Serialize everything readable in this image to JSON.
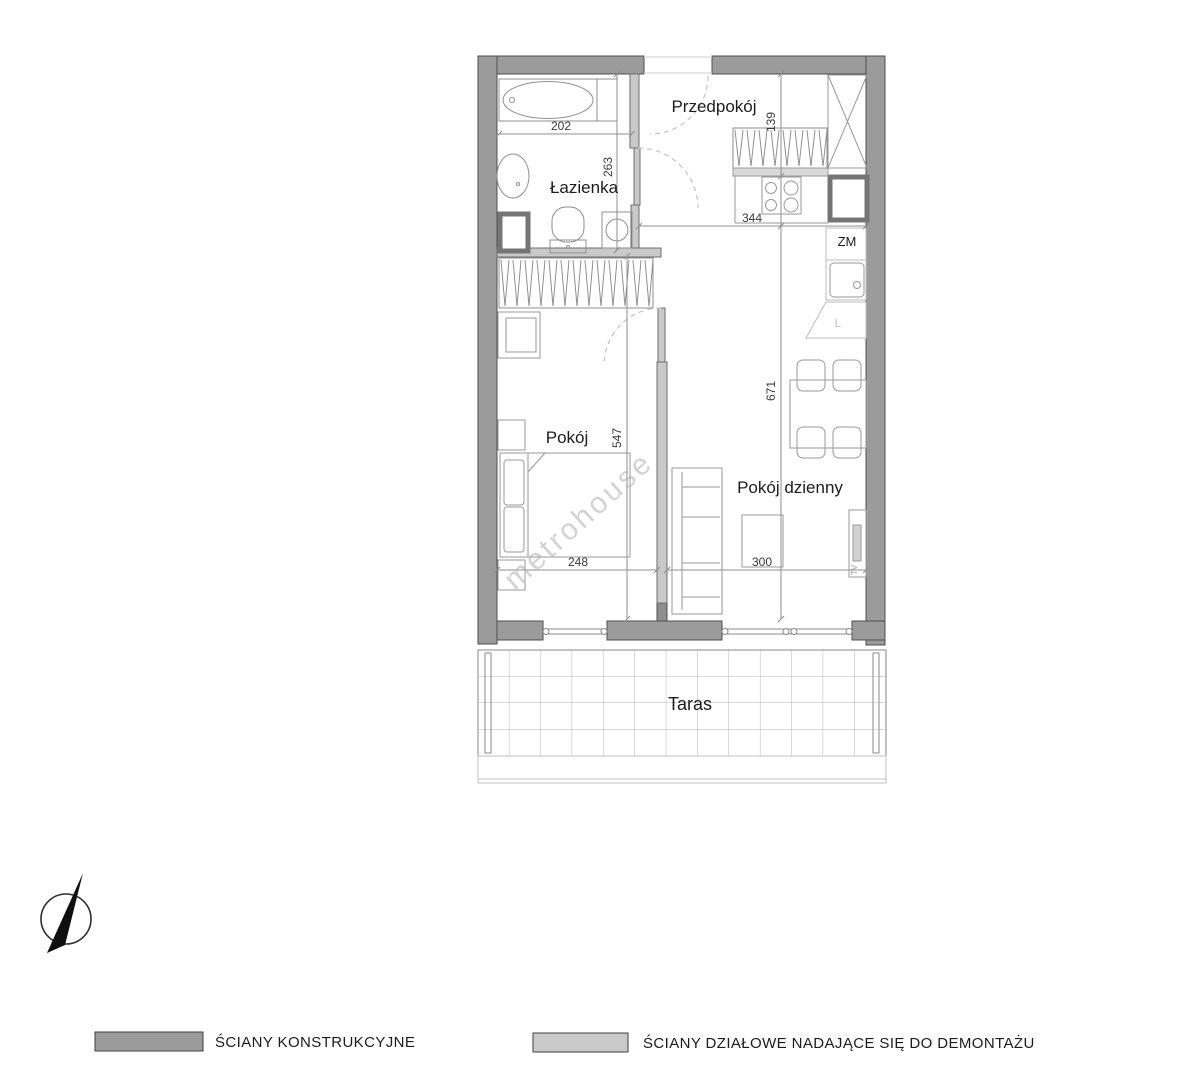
{
  "plan": {
    "room_labels": {
      "hall": "Przedpokój",
      "bathroom": "Łazienka",
      "bedroom": "Pokój",
      "living_room": "Pokój dzienny",
      "terrace": "Taras"
    },
    "fixture_labels": {
      "zm": "ZM",
      "fridge": "L",
      "tv": "TV"
    },
    "dimensions_cm": {
      "bathtub_wall": "202",
      "bathroom_depth": "263",
      "hall_wardrobe_depth": "139",
      "kitchen_wall": "344",
      "living_depth": "671",
      "bedroom_depth": "547",
      "bedroom_width": "248",
      "living_width": "300"
    }
  },
  "legend": {
    "structural_label": "ŚCIANY KONSTRUKCYJNE",
    "partition_label": "ŚCIANY DZIAŁOWE NADAJĄCE SIĘ DO DEMONTAŻU"
  },
  "watermark": "metrohouse",
  "colors": {
    "structural_wall": "#9b9b9b",
    "partition_wall": "#c9c9c9"
  }
}
